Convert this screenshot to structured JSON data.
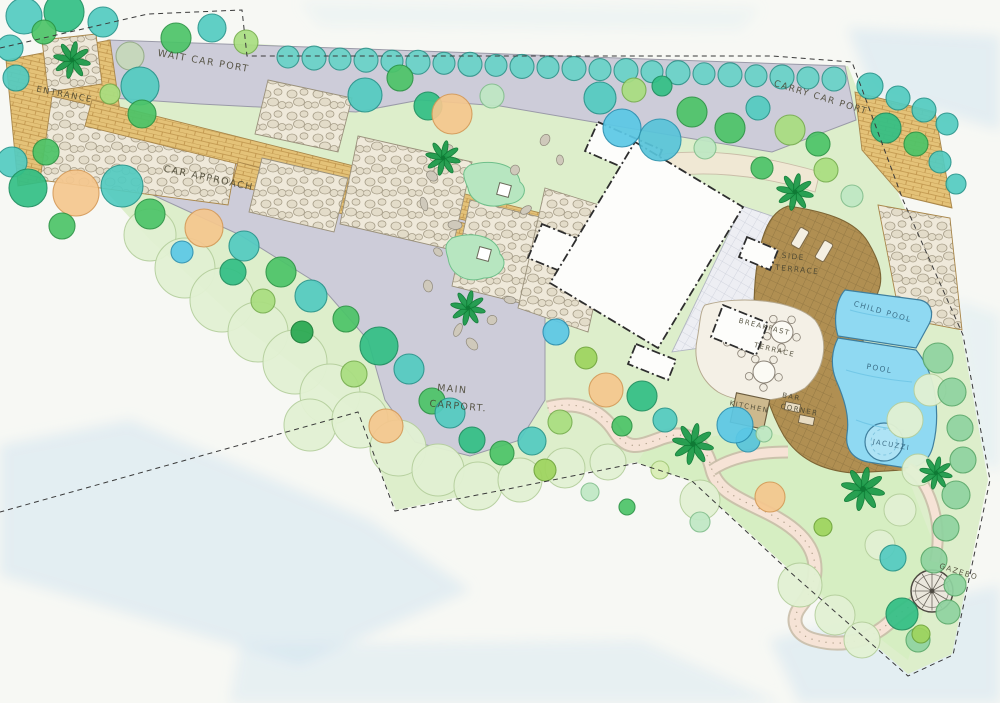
{
  "document": {
    "type": "hand-drawn landscape garden master plan",
    "view": "top-down plan"
  },
  "palette": {
    "paper": "#f7f8f4",
    "water_wash": "#cfe4f0",
    "lawn": "#ddeecb",
    "lawn_dark": "#d4edbf",
    "driveway": "#cdccd9",
    "brick_paving": "#e4c278",
    "brick_joint": "#bd9249",
    "flagstone": "#efe9da",
    "tile_court": "#edeef3",
    "wood_deck": "#b08f52",
    "pool_water": "#8fd9f2",
    "pool_edge": "#3f7f9e",
    "terrace": "#f4f0e6",
    "garden_path": "#f6e3d6",
    "house_fill": "#fdfdfb",
    "ink": "#3a3a3a",
    "label_ink": "#45422f"
  },
  "labels": {
    "wait_car_port": {
      "text": "WAIT CAR PORT"
    },
    "entrance": {
      "text": "ENTRANCE"
    },
    "car_approach": {
      "text": "CAR APPROACH"
    },
    "carry_car_port": {
      "text": "CARRY CAR PORT"
    },
    "main_carport_line1": {
      "text": "MAIN"
    },
    "main_carport_line2": {
      "text": "CARPORT."
    },
    "side_terrace_line1": {
      "text": "SIDE"
    },
    "side_terrace_line2": {
      "text": "TERRACE"
    },
    "breakfast_terrace_line1": {
      "text": "BREAKFAST"
    },
    "breakfast_terrace_line2": {
      "text": "TERRACE"
    },
    "kitchen": {
      "text": "KITCHEN"
    },
    "bar_corner_line1": {
      "text": "BAR"
    },
    "bar_corner_line2": {
      "text": "CORNER"
    },
    "child_pool": {
      "text": "CHILD POOL"
    },
    "pool": {
      "text": "POOL"
    },
    "jacuzzi": {
      "text": "JACUZZI"
    },
    "gazebo": {
      "text": "GAZEBO"
    }
  },
  "planting": {
    "hedge_row": {
      "x1": 288,
      "y1": 57,
      "x2": 834,
      "y2": 79,
      "n": 22,
      "r": 11
    },
    "clouds": [
      [
        150,
        235,
        26
      ],
      [
        185,
        268,
        30
      ],
      [
        222,
        300,
        32
      ],
      [
        258,
        332,
        30
      ],
      [
        295,
        362,
        32
      ],
      [
        330,
        394,
        30
      ],
      [
        310,
        425,
        26
      ],
      [
        360,
        420,
        28
      ],
      [
        398,
        448,
        28
      ],
      [
        438,
        470,
        26
      ],
      [
        478,
        486,
        24
      ],
      [
        520,
        480,
        22
      ],
      [
        565,
        468,
        20
      ],
      [
        608,
        462,
        18
      ],
      [
        800,
        585,
        22
      ],
      [
        835,
        615,
        20
      ],
      [
        862,
        640,
        18
      ],
      [
        700,
        500,
        20
      ],
      [
        905,
        420,
        18
      ],
      [
        930,
        390,
        16
      ],
      [
        918,
        470,
        16
      ],
      [
        900,
        510,
        16
      ],
      [
        880,
        545,
        15
      ]
    ],
    "hedge_scallops": [
      [
        938,
        358,
        15
      ],
      [
        952,
        392,
        14
      ],
      [
        960,
        428,
        13
      ],
      [
        963,
        460,
        13
      ],
      [
        956,
        495,
        14
      ],
      [
        946,
        528,
        13
      ],
      [
        934,
        560,
        13
      ],
      [
        955,
        585,
        11
      ],
      [
        948,
        612,
        12
      ],
      [
        918,
        640,
        12
      ]
    ],
    "trees": [
      [
        "teal",
        24,
        16,
        18
      ],
      [
        "emerald",
        64,
        12,
        20
      ],
      [
        "teal",
        103,
        22,
        15
      ],
      [
        "teal",
        10,
        48,
        13
      ],
      [
        "teal",
        16,
        78,
        13
      ],
      [
        "green",
        44,
        32,
        12
      ],
      [
        "sage",
        130,
        56,
        14
      ],
      [
        "teal",
        140,
        86,
        19
      ],
      [
        "green",
        142,
        114,
        14
      ],
      [
        "ltgreen",
        110,
        94,
        10
      ],
      [
        "green",
        176,
        38,
        15
      ],
      [
        "teal",
        212,
        28,
        14
      ],
      [
        "ltgreen",
        246,
        42,
        12
      ],
      [
        "teal",
        365,
        95,
        17
      ],
      [
        "green",
        400,
        78,
        13
      ],
      [
        "emerald",
        428,
        106,
        14
      ],
      [
        "orange",
        452,
        114,
        20
      ],
      [
        "mint",
        492,
        96,
        12
      ],
      [
        "teal",
        600,
        98,
        16
      ],
      [
        "ltgreen",
        634,
        90,
        12
      ],
      [
        "cyan",
        622,
        128,
        19
      ],
      [
        "cyan2",
        660,
        140,
        21
      ],
      [
        "green",
        692,
        112,
        15
      ],
      [
        "mint",
        705,
        148,
        11
      ],
      [
        "green",
        730,
        128,
        15
      ],
      [
        "teal",
        758,
        108,
        12
      ],
      [
        "ltgreen",
        790,
        130,
        15
      ],
      [
        "green",
        818,
        144,
        12
      ],
      [
        "emerald",
        662,
        86,
        10
      ],
      [
        "teal",
        870,
        86,
        13
      ],
      [
        "teal",
        898,
        98,
        12
      ],
      [
        "teal",
        924,
        110,
        12
      ],
      [
        "teal",
        947,
        124,
        11
      ],
      [
        "emerald",
        886,
        128,
        15
      ],
      [
        "green",
        916,
        144,
        12
      ],
      [
        "teal",
        940,
        162,
        11
      ],
      [
        "teal",
        956,
        184,
        10
      ],
      [
        "green",
        762,
        168,
        11
      ],
      [
        "ltgreen",
        826,
        170,
        12
      ],
      [
        "mint",
        852,
        196,
        11
      ],
      [
        "teal",
        12,
        162,
        15
      ],
      [
        "green",
        46,
        152,
        13
      ],
      [
        "emerald",
        28,
        188,
        19
      ],
      [
        "orange",
        76,
        193,
        23
      ],
      [
        "teal",
        122,
        186,
        21
      ],
      [
        "green",
        62,
        226,
        13
      ],
      [
        "green",
        150,
        214,
        15
      ],
      [
        "orange",
        204,
        228,
        19
      ],
      [
        "teal",
        244,
        246,
        15
      ],
      [
        "cyan",
        182,
        252,
        11
      ],
      [
        "emerald",
        233,
        272,
        13
      ],
      [
        "green",
        281,
        272,
        15
      ],
      [
        "ltgreen",
        263,
        301,
        12
      ],
      [
        "teal",
        311,
        296,
        16
      ],
      [
        "green",
        346,
        319,
        13
      ],
      [
        "dkgreen",
        302,
        332,
        11
      ],
      [
        "emerald",
        379,
        346,
        19
      ],
      [
        "ltgreen",
        354,
        374,
        13
      ],
      [
        "teal",
        409,
        369,
        15
      ],
      [
        "orange",
        386,
        426,
        17
      ],
      [
        "green",
        432,
        401,
        13
      ],
      [
        "teal",
        450,
        413,
        15
      ],
      [
        "emerald",
        472,
        440,
        13
      ],
      [
        "green",
        502,
        453,
        12
      ],
      [
        "teal",
        532,
        441,
        14
      ],
      [
        "ltgreen",
        560,
        422,
        12
      ],
      [
        "orange",
        606,
        390,
        17
      ],
      [
        "emerald",
        642,
        396,
        15
      ],
      [
        "ygreen",
        586,
        358,
        11
      ],
      [
        "cyan",
        556,
        332,
        13
      ],
      [
        "green",
        622,
        426,
        10
      ],
      [
        "teal",
        665,
        420,
        12
      ],
      [
        "ygreen",
        545,
        470,
        11
      ],
      [
        "mint",
        590,
        492,
        9
      ],
      [
        "green",
        627,
        507,
        8
      ],
      [
        "cyan2",
        748,
        440,
        12
      ],
      [
        "orange",
        770,
        497,
        15
      ],
      [
        "ygreen",
        823,
        527,
        9
      ],
      [
        "teal",
        893,
        558,
        13
      ],
      [
        "emerald",
        902,
        614,
        16
      ],
      [
        "ygreen",
        921,
        634,
        9
      ],
      [
        "mint",
        700,
        522,
        10
      ],
      [
        "pale",
        660,
        470,
        9
      ],
      [
        "cyan",
        735,
        425,
        18
      ],
      [
        "mint",
        764,
        434,
        8
      ]
    ],
    "palms": [
      [
        72,
        60,
        0.85
      ],
      [
        443,
        158,
        0.8
      ],
      [
        468,
        308,
        0.8
      ],
      [
        795,
        192,
        0.85
      ],
      [
        693,
        444,
        0.95
      ],
      [
        863,
        489,
        1.0
      ],
      [
        936,
        473,
        0.75
      ]
    ],
    "rocks": [
      [
        448,
        148
      ],
      [
        432,
        176
      ],
      [
        424,
        204
      ],
      [
        515,
        170
      ],
      [
        526,
        210
      ],
      [
        455,
        225
      ],
      [
        438,
        252
      ],
      [
        428,
        286
      ],
      [
        458,
        330
      ],
      [
        492,
        320
      ],
      [
        510,
        300
      ],
      [
        472,
        344
      ],
      [
        560,
        160
      ],
      [
        545,
        140
      ]
    ]
  },
  "furniture": {
    "tables": [
      [
        742,
        338
      ],
      [
        782,
        332
      ],
      [
        764,
        372
      ]
    ],
    "loungers": [
      [
        800,
        238
      ],
      [
        824,
        251
      ]
    ],
    "gazebo": {
      "x": 932,
      "y": 591,
      "r": 21,
      "spokes": 12
    }
  }
}
